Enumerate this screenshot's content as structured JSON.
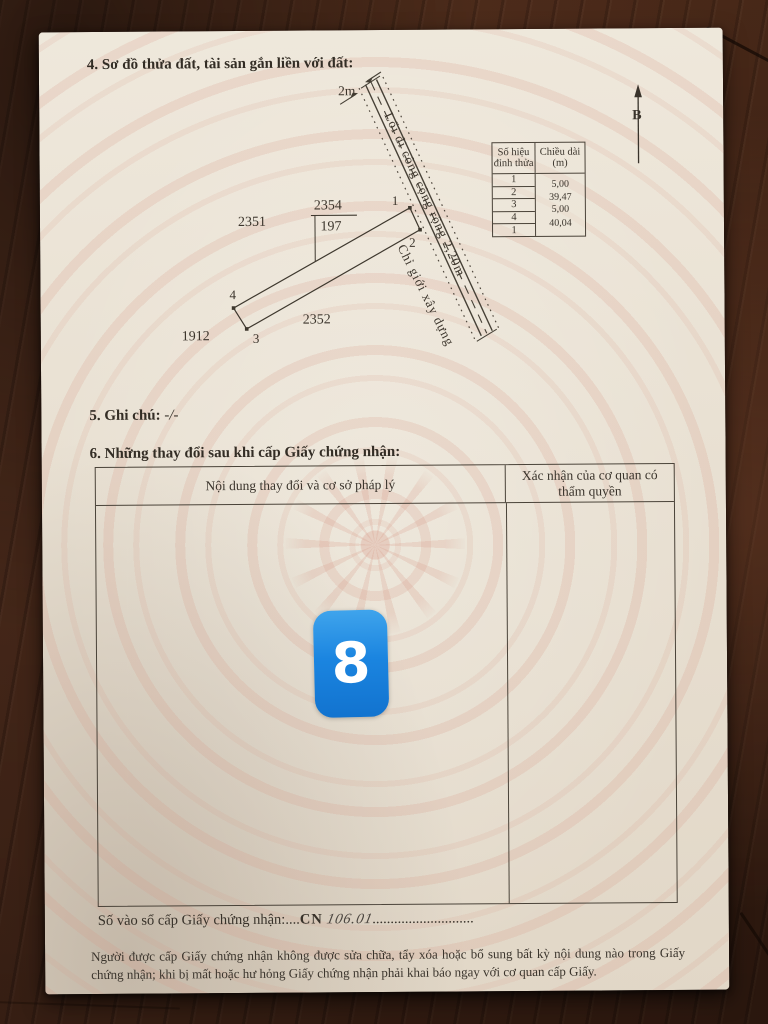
{
  "colors": {
    "badge_blue": "#1e87e2",
    "paper": "#e9e1d3",
    "ink": "#3a342c",
    "watermark_pink": "#d69684"
  },
  "sections": {
    "s4_title": "4. Sơ đồ thửa đất, tài sản gắn liền với đất:",
    "s5_label": "5. Ghi chú:",
    "s5_value": "-/-",
    "s6_title": "6. Những thay đổi sau khi cấp Giấy chứng nhận:"
  },
  "diagram": {
    "north_label": "B",
    "road_width_label": "2m",
    "road_name": "Lối đi công cộng rộng 2,20m",
    "boundary_label": "Chỉ giới xây dựng",
    "parcel_number": "2354",
    "parcel_area": "197",
    "adjacent_parcels": [
      "2351",
      "1912",
      "2352"
    ],
    "vertices": [
      "1",
      "2",
      "3",
      "4"
    ],
    "vertex_table": {
      "col1_header": "Số hiệu đỉnh thửa",
      "col2_header": "Chiều dài (m)",
      "vertex_ids": [
        "1",
        "2",
        "3",
        "4",
        "1"
      ],
      "lengths": [
        "5,00",
        "39,47",
        "5,00",
        "40,04"
      ]
    }
  },
  "changes_table": {
    "col1_header": "Nội dung thay đổi và cơ sở pháp lý",
    "col2_header": "Xác nhận của cơ quan có thẩm quyền"
  },
  "page_marker": "8",
  "footer": {
    "registry_label": "Số vào sổ cấp Giấy chứng nhận:....",
    "registry_code": "CN",
    "registry_number": "106.01",
    "registry_dots": "............................",
    "notice": "Người được cấp Giấy chứng nhận không được sửa chữa, tẩy xóa hoặc bổ sung bất kỳ nội dung nào trong Giấy chứng nhận; khi bị mất hoặc hư hỏng Giấy chứng nhận phải khai báo ngay với cơ quan cấp Giấy."
  }
}
